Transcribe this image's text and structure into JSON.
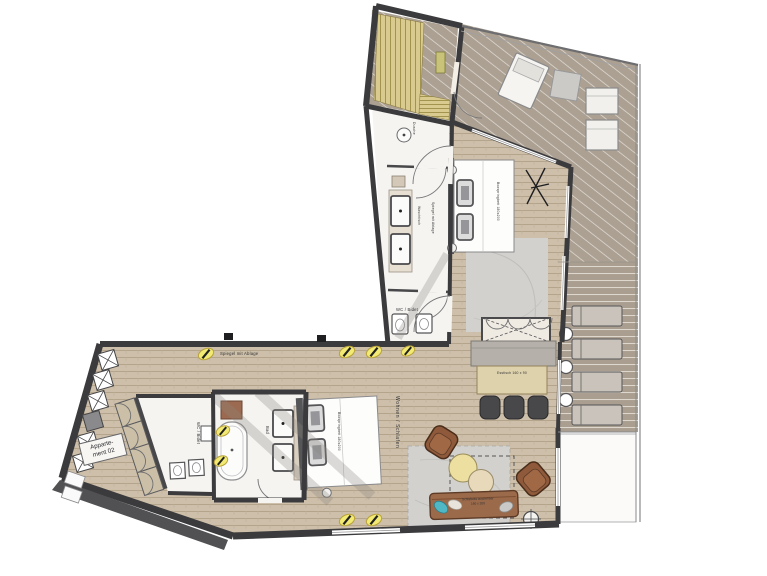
{
  "apartment": {
    "line1": "Apparte-",
    "line2": "ment 02"
  },
  "rooms": {
    "living": "Wohnen / Schlafen",
    "bath": "Bad",
    "wc_upper": "WC / Bidet",
    "wc_lower": "WC / Bidet",
    "shower": "Dusche"
  },
  "fixtures": {
    "mirror_entry": "Spiegel mit Ablage",
    "mirror_bath": "Spiegel mit Ablage",
    "washstand": "Waschtisch"
  },
  "furniture": {
    "bed_main": "Boxspringbett 180x200",
    "bed_living": "Boxspringbett 180x200",
    "sofa_line1": "Schlafsofa ausziehbar",
    "sofa_line2": "160 x 200",
    "dining_table": "Esstisch 160 x 90"
  },
  "colors": {
    "wall": "#3b3b3d",
    "wood_floor": "#cdbfa9",
    "deck": "#aba092",
    "bath_floor": "#f5f4f1",
    "sauna_wood": "#d9cb90",
    "lamp_yellow": "#f2ea72",
    "furniture_brown": "#8f5a3c",
    "rug_gray": "#d2d1ce"
  }
}
